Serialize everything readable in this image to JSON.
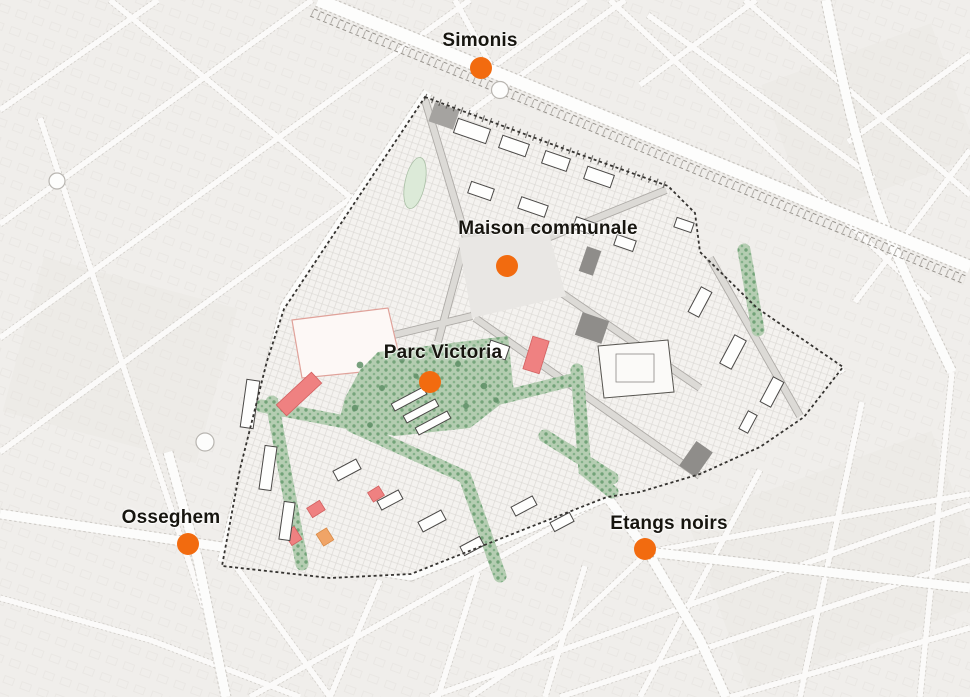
{
  "map": {
    "type": "annotated-urban-plan-map",
    "markers": [
      {
        "id": "simonis",
        "label": "Simonis",
        "dot": {
          "x": 481,
          "y": 68
        },
        "label_pos": {
          "x": 480,
          "y": 41
        }
      },
      {
        "id": "maison-communale",
        "label": "Maison communale",
        "dot": {
          "x": 507,
          "y": 266
        },
        "label_pos": {
          "x": 548,
          "y": 229
        }
      },
      {
        "id": "parc-victoria",
        "label": "Parc Victoria",
        "dot": {
          "x": 430,
          "y": 382
        },
        "label_pos": {
          "x": 443,
          "y": 353
        }
      },
      {
        "id": "osseghem",
        "label": "Osseghem",
        "dot": {
          "x": 188,
          "y": 544
        },
        "label_pos": {
          "x": 171,
          "y": 518
        }
      },
      {
        "id": "etangs-noirs",
        "label": "Etangs noirs",
        "dot": {
          "x": 645,
          "y": 549
        },
        "label_pos": {
          "x": 669,
          "y": 524
        }
      }
    ],
    "colors": {
      "marker": "#F26B0F",
      "label_text": "#17150F",
      "map_background": "#F0EEEB",
      "street": "#FDFDFC",
      "study_area_fill": "#F4F2EF",
      "study_boundary": "#34322F",
      "park_green": "#B3CCB0",
      "tree_green": "#5F9067",
      "highlight_red": "#EF8181",
      "highlight_orange": "#F0A467",
      "building_gray": "#8F8D8A",
      "pond_green": "#DCEAD8"
    }
  }
}
